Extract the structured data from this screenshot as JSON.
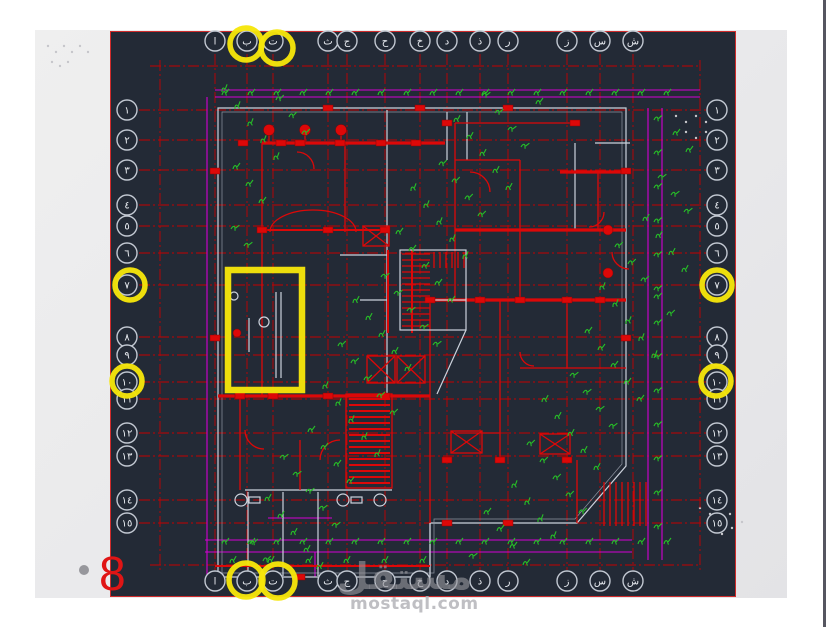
{
  "page": {
    "number": "8",
    "watermark_logo": "مستقل",
    "watermark_domain": "mostaql.com"
  },
  "colors": {
    "bg_dark": "#232a36",
    "grid_red": "#c40000",
    "wall_red": "#dd0808",
    "magenta": "#d400d4",
    "green": "#27c127",
    "wall_white": "#ccd2dc",
    "marker_stroke": "#c2c8d2",
    "yellow": "#f6e60a",
    "page_red": "#e01515",
    "slide_gray": "#e9e9eb",
    "watermark_gray": "#a8a8ad"
  },
  "drawing": {
    "columns": [
      {
        "label": "ا",
        "x": 215,
        "circled": false
      },
      {
        "label": "ب",
        "x": 247,
        "circled": true
      },
      {
        "label": "ت",
        "x": 273,
        "circled": true
      },
      {
        "label": "ث",
        "x": 328,
        "circled": false
      },
      {
        "label": "ج",
        "x": 347,
        "circled": false
      },
      {
        "label": "ح",
        "x": 385,
        "circled": false
      },
      {
        "label": "خ",
        "x": 420,
        "circled": false
      },
      {
        "label": "د",
        "x": 447,
        "circled": false
      },
      {
        "label": "ذ",
        "x": 480,
        "circled": false
      },
      {
        "label": "ر",
        "x": 508,
        "circled": false
      },
      {
        "label": "ز",
        "x": 567,
        "circled": false
      },
      {
        "label": "س",
        "x": 600,
        "circled": false
      },
      {
        "label": "ش",
        "x": 633,
        "circled": false
      }
    ],
    "rows": [
      {
        "label": "١",
        "y": 110,
        "circled": false
      },
      {
        "label": "٢",
        "y": 140,
        "circled": false
      },
      {
        "label": "٣",
        "y": 170,
        "circled": false
      },
      {
        "label": "٤",
        "y": 205,
        "circled": false
      },
      {
        "label": "٥",
        "y": 226,
        "circled": false
      },
      {
        "label": "٦",
        "y": 253,
        "circled": false
      },
      {
        "label": "٧",
        "y": 285,
        "circled": true
      },
      {
        "label": "٨",
        "y": 337,
        "circled": false
      },
      {
        "label": "٩",
        "y": 355,
        "circled": false
      },
      {
        "label": "١٠",
        "y": 382,
        "circled": true
      },
      {
        "label": "١١",
        "y": 399,
        "circled": false
      },
      {
        "label": "١٢",
        "y": 433,
        "circled": false
      },
      {
        "label": "١٣",
        "y": 456,
        "circled": false
      },
      {
        "label": "١٤",
        "y": 500,
        "circled": false
      },
      {
        "label": "١٥",
        "y": 523,
        "circled": false
      }
    ],
    "highlights": {
      "circles": [
        {
          "x": 246,
          "y": 44,
          "r": 16
        },
        {
          "x": 277,
          "y": 48,
          "r": 16
        },
        {
          "x": 246,
          "y": 580,
          "r": 17
        },
        {
          "x": 278,
          "y": 581,
          "r": 17
        },
        {
          "x": 130,
          "y": 285,
          "r": 15
        },
        {
          "x": 717,
          "y": 285,
          "r": 15
        },
        {
          "x": 127,
          "y": 381,
          "r": 15
        },
        {
          "x": 716,
          "y": 381,
          "r": 15
        }
      ],
      "rect": {
        "x": 228,
        "y": 270,
        "w": 74,
        "h": 120
      }
    }
  }
}
